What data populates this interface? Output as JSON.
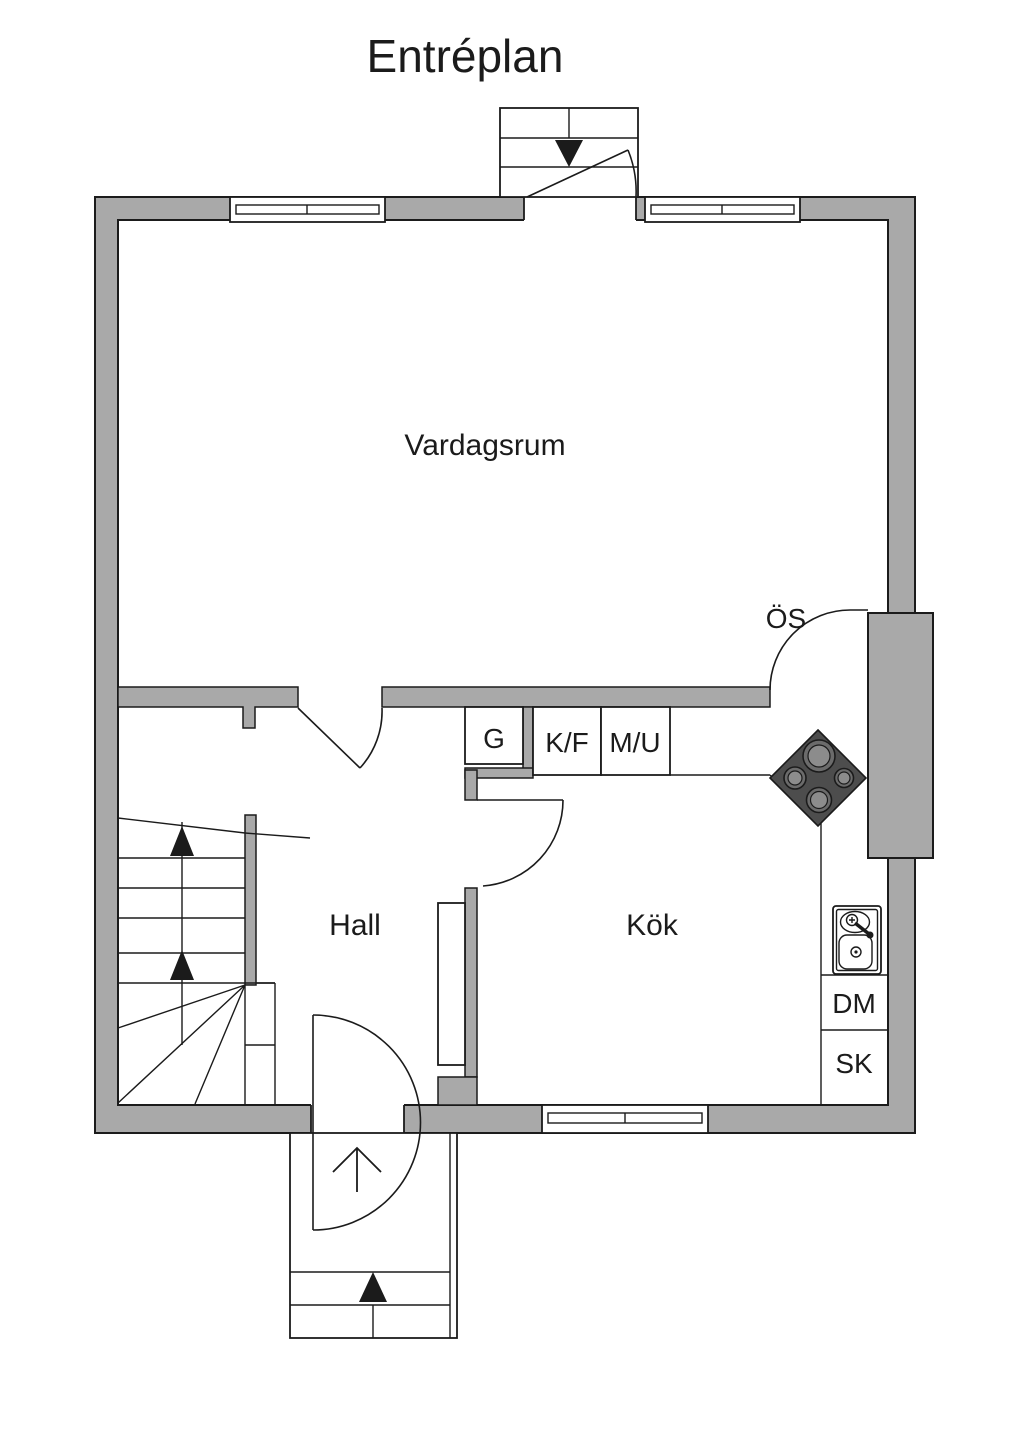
{
  "title": "Entréplan",
  "colors": {
    "wall_fill": "#a9a9a9",
    "line": "#1b1b1b",
    "stove_fill": "#4d4d4d",
    "burner_fill": "#6b6b6b",
    "burner_inner": "#8c8c8c"
  },
  "rooms": {
    "living_room": "Vardagsrum",
    "hall": "Hall",
    "kitchen": "Kök"
  },
  "fixtures": {
    "wardrobe": "G",
    "fridge_freezer": "K/F",
    "microwave_oven": "M/U",
    "open_fireplace": "ÖS",
    "dishwasher": "DM",
    "cabinet": "SK"
  }
}
